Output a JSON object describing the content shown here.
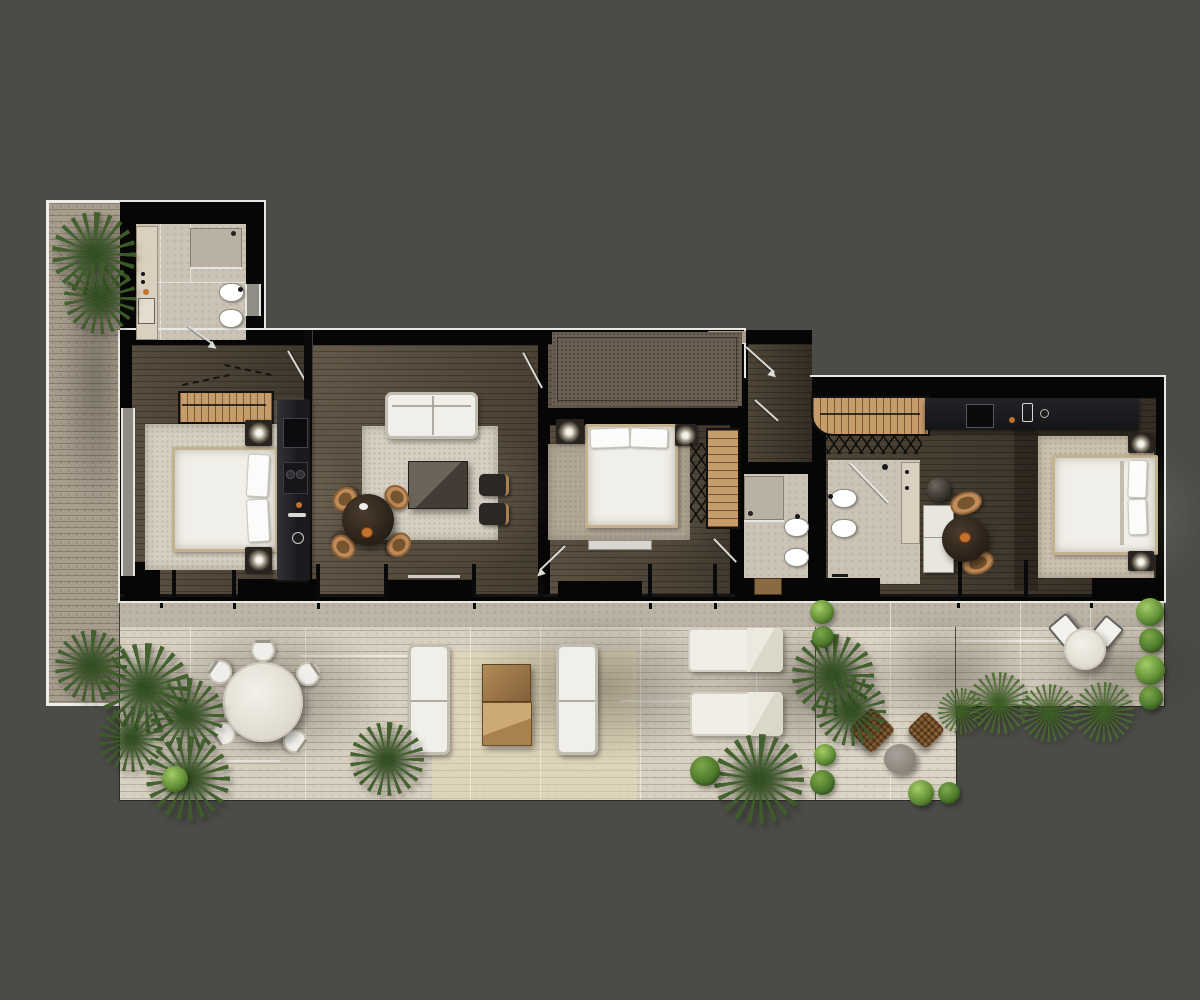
{
  "scene": {
    "label": "Furnished apartment floor plan, top-down architectural render with wrap-around wooden terrace",
    "background": "#4b4b48"
  },
  "palette": {
    "background": "#4b4b48",
    "wall": "#060606",
    "facade_line": "#e8e7e2",
    "deck": "#d8d1c2",
    "deck_right": "#ddd6c7",
    "deck_strip": "#a69d8d",
    "deck_concrete": "#bcb4a6",
    "tile": "#cbc4b6",
    "rug_light": "#d6d0c2",
    "rug_warm": "#b2a796",
    "rug_wing": "#ccc1af",
    "rug_entry": "#6b6054",
    "white_furniture": "#f1efe9",
    "bed_frame": "#c3b290",
    "tan": "#c08b58",
    "tan_dark": "#77552f",
    "closet": "#c79c6b",
    "dark_furniture": "#2b2724",
    "counter": "#191a1c",
    "pouf": "#8a6136",
    "table_gray": "#9a948c",
    "green_light": "#8fb957",
    "green_dark": "#33531e",
    "accent_orange": "#c4722e",
    "glass_line": "#d9d9d4"
  },
  "building": {
    "rooms": [
      {
        "id": "bathroom-top",
        "label": "Bathroom 1",
        "furniture": [
          "shower-tray",
          "toilet",
          "bidet",
          "vanity-counter",
          "door-swing",
          "wall-window"
        ]
      },
      {
        "id": "bedroom-left",
        "label": "Bedroom 1",
        "furniture": [
          "wardrobe-rack",
          "double-bed",
          "area-rug",
          "nightstand-lamp-left",
          "nightstand-lamp-right",
          "full-height-window"
        ]
      },
      {
        "id": "living-room",
        "label": "Living room",
        "furniture": [
          "sofa",
          "area-rug",
          "coffee-table",
          "round-dining-table",
          "dining-chairs-x4",
          "stools-x2",
          "media-wall-unit",
          "low-consoles"
        ]
      },
      {
        "id": "entry-hall",
        "label": "Entry hall",
        "furniture": [
          "textured-doormat-rug",
          "entrance-door-swing"
        ]
      },
      {
        "id": "bedroom-middle",
        "label": "Bedroom 2",
        "furniture": [
          "double-bed",
          "bedside-lamps-x2",
          "area-rug",
          "wardrobe-shelves",
          "hanger-rail",
          "foot-bench",
          "door-swing"
        ]
      },
      {
        "id": "bathroom-middle",
        "label": "Bathroom 2",
        "furniture": [
          "shower",
          "toilet",
          "bidet",
          "wood-mat",
          "door-swing"
        ]
      },
      {
        "id": "corridor",
        "label": "Corridor",
        "furniture": [
          "door-swing"
        ]
      },
      {
        "id": "walk-in-closet",
        "label": "Walk-in closet",
        "furniture": [
          "clothes-rack",
          "hanger-marks"
        ]
      },
      {
        "id": "kitchenette",
        "label": "Kitchenette counter",
        "furniture": [
          "dark-counter",
          "sink",
          "accessories"
        ]
      },
      {
        "id": "bathroom-right",
        "label": "Bathroom 3",
        "furniture": [
          "shower-glass",
          "toilet",
          "bidet",
          "vanity-strip"
        ]
      },
      {
        "id": "bedroom-right",
        "label": "Bedroom 3",
        "furniture": [
          "double-bed",
          "area-rug",
          "wall-lamps-x2",
          "white-sideboard",
          "basin-stand",
          "round-tea-table",
          "tan-chairs-x2"
        ]
      }
    ]
  },
  "terraces": [
    {
      "id": "planter-strip",
      "label": "Side planter strip",
      "plants": [
        "palm",
        "palm"
      ]
    },
    {
      "id": "main-terrace",
      "label": "Main terrace",
      "furniture": [
        "round-dining-table",
        "terrace-chairs-x5",
        "outdoor-sofas-x2",
        "wood-coffee-tables-x2",
        "sun-loungers-x2"
      ],
      "plants": [
        "palm-cluster",
        "palms",
        "bushes"
      ]
    },
    {
      "id": "lounge-terrace",
      "label": "Lounge terrace",
      "furniture": [
        "rattan-poufs-x2",
        "round-side-table"
      ],
      "plants": [
        "bush-row",
        "palms"
      ]
    },
    {
      "id": "bistro-terrace",
      "label": "Bistro terrace",
      "furniture": [
        "bistro-table",
        "bistro-chairs-x2"
      ],
      "plants": [
        "potted-bushes-x4",
        "ferns"
      ]
    }
  ]
}
